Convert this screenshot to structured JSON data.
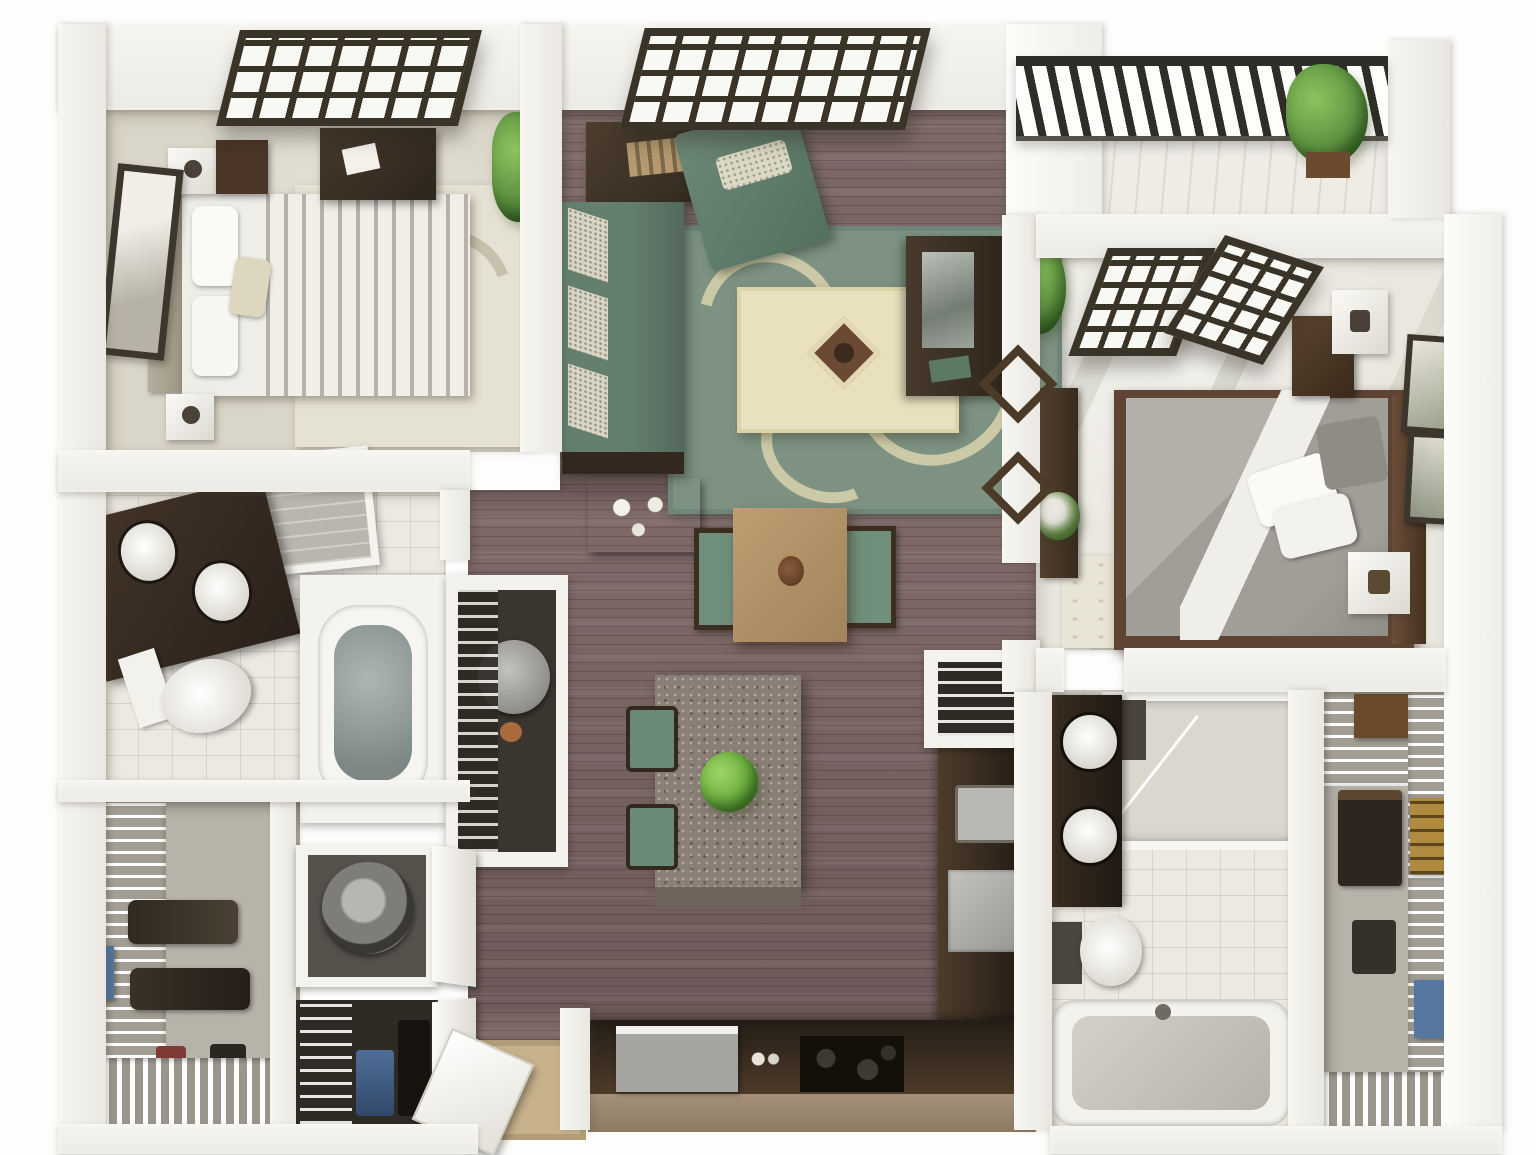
{
  "meta": {
    "title": "3D rendered two-bedroom apartment floor plan, top-down view",
    "view": "isometric top-down architectural rendering",
    "visible_text": "none"
  },
  "palette": {
    "wall_white": "#f3f2ed",
    "wood_floor_mauve": "#77615f",
    "bedroom1_carpet": "#d9d5c8",
    "bedroom2_tile": "#e9e7de",
    "bathroom_tile": "#ece9e1",
    "closet_floor_gray": "#b7b3a9",
    "sofa_sage_green": "#647f6e",
    "rug_green": "#7d9282",
    "rug_cream_scroll": "#d7d2ab",
    "ottoman_cream": "#e9e1bd",
    "dark_wood": "#3f3227",
    "dining_table_oak": "#b2926a",
    "island_granite": "#8a7f76",
    "kitchen_cabinet_brown": "#4e3c2b",
    "countertop_black": "#17140f",
    "appliance_gray": "#a5a4a1",
    "window_frame_dark": "#3a3428",
    "plant_green": "#5f9442",
    "denim_blue": "#54759e",
    "brass_gold": "#b08a3e"
  },
  "rooms": [
    {
      "id": "bedroom-1",
      "label": "Bedroom 1 (top left)",
      "floor": "beige carpet",
      "items": [
        "dark grid window",
        "queen bed with gray striped duvet",
        "upholstered headboard",
        "two white cube nightstands",
        "dark wood nightstand",
        "storage bench with papers",
        "tall framed wall art",
        "cream leaf-pattern area rug"
      ]
    },
    {
      "id": "living-room",
      "label": "Living room (top center)",
      "floor": "mauve wood planks",
      "items": [
        "wide dark grid window",
        "potted plant",
        "console desk",
        "sage green chaise with patterned pillow",
        "sage green sofa with three patterned cushions",
        "dark side table with tea set",
        "green scroll-pattern rug",
        "cream ottoman with diamond tray",
        "dark wood media console",
        "two diamond wall ornaments"
      ]
    },
    {
      "id": "balcony",
      "label": "Balcony (top right)",
      "floor": "white deck",
      "items": [
        "dark metal slat railing",
        "potted plant"
      ]
    },
    {
      "id": "bedroom-2",
      "label": "Bedroom 2 (right)",
      "floor": "light tile with foliage shadows",
      "items": [
        "two dark-frame french doors",
        "gray bed with white sheets",
        "white pillows",
        "dark wood headboard",
        "white cube nightstand with lamp",
        "dark dresser with white cube lamp",
        "two framed artworks on right wall",
        "console table with plant",
        "tall corner plant",
        "light area rug"
      ]
    },
    {
      "id": "bathroom-1",
      "label": "Bathroom 1 (middle left)",
      "floor": "beige tile",
      "items": [
        "angled dark double vanity with two oval sinks",
        "white toilet",
        "gray tiled shower",
        "towel shelf"
      ]
    },
    {
      "id": "utility-core",
      "label": "Tub alcove and water-heater closet (center left)",
      "floor": "tile",
      "items": [
        "soaking tub",
        "water heater with dial",
        "wire shelving"
      ]
    },
    {
      "id": "dining-area",
      "label": "Dining area (center)",
      "floor": "mauve wood planks",
      "items": [
        "square oak dining table with centerpiece",
        "two green-seat chairs"
      ]
    },
    {
      "id": "kitchen",
      "label": "Kitchen (bottom center)",
      "floor": "mauve wood planks",
      "items": [
        "granite island with green plant",
        "two green bar stools",
        "L-shaped brown counter with black top",
        "gray refrigerator",
        "black cooktop with burners",
        "stainless dishwasher",
        "pantry with wire shelves"
      ]
    },
    {
      "id": "walk-in-closet-1",
      "label": "Walk-in closet (bottom left)",
      "floor": "gray carpet",
      "items": [
        "white wire shelving",
        "hanging dark clothes",
        "blue storage bin",
        "shoe rack rows"
      ]
    },
    {
      "id": "laundry-closet",
      "label": "Laundry closet",
      "floor": "white",
      "items": [
        "front-load washer with round door",
        "white bifold doors"
      ]
    },
    {
      "id": "linen-closet",
      "label": "Second closet with jeans",
      "floor": "dark",
      "items": [
        "wire shelves",
        "hanging jeans",
        "dark garments"
      ]
    },
    {
      "id": "entry",
      "label": "Entry (bottom center)",
      "floor": "wood with mat",
      "items": [
        "open white front door",
        "tan doormat"
      ]
    },
    {
      "id": "bathroom-2",
      "label": "Bathroom 2 (bottom right)",
      "floor": "white tile",
      "items": [
        "tiled shower stall with glass",
        "dark double-sink vanity",
        "white toilet",
        "white bathtub"
      ]
    },
    {
      "id": "walk-in-closet-2",
      "label": "Walk-in closet 2 (bottom right corner)",
      "floor": "gray carpet",
      "items": [
        "wire shelving right wall",
        "top wire shelf with brown box",
        "gold ladder shelf",
        "hanging clothes",
        "blue storage bins",
        "white slat shoe rack"
      ]
    }
  ]
}
